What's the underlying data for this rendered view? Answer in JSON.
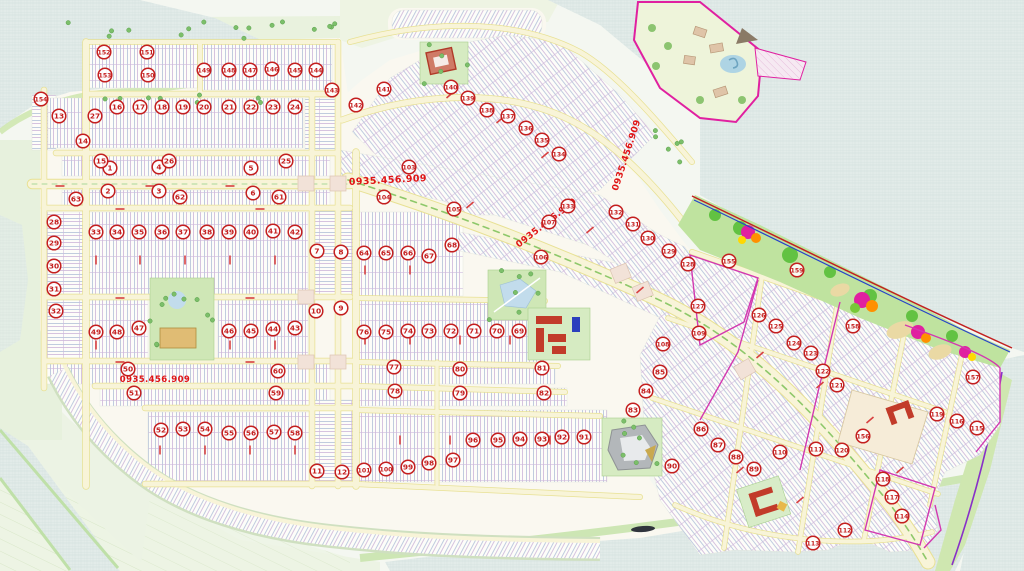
{
  "map": {
    "type": "real-estate-master-plan",
    "watermark": {
      "text": "0935.456.909",
      "color": "#e01414",
      "positions": [
        {
          "x": 388,
          "y": 183,
          "rot": -3,
          "size": 9.5
        },
        {
          "x": 548,
          "y": 225,
          "rot": -38,
          "size": 9
        },
        {
          "x": 629,
          "y": 156,
          "rot": -72,
          "size": 9
        },
        {
          "x": 155,
          "y": 382,
          "rot": 0,
          "size": 8.5
        }
      ]
    },
    "marker_style": {
      "ring_color": "#c41f1f",
      "fill": "#ffffff"
    },
    "markers": {
      "items": [
        [
          1,
          110,
          168
        ],
        [
          2,
          108,
          191
        ],
        [
          3,
          159,
          191
        ],
        [
          4,
          159,
          167
        ],
        [
          5,
          251,
          168
        ],
        [
          6,
          253,
          193
        ],
        [
          7,
          317,
          251
        ],
        [
          8,
          341,
          252
        ],
        [
          9,
          341,
          308
        ],
        [
          10,
          316,
          311
        ],
        [
          11,
          317,
          471
        ],
        [
          12,
          342,
          472
        ],
        [
          13,
          59,
          116
        ],
        [
          14,
          83,
          141
        ],
        [
          15,
          101,
          161
        ],
        [
          16,
          117,
          107
        ],
        [
          17,
          140,
          107
        ],
        [
          18,
          162,
          107
        ],
        [
          19,
          183,
          107
        ],
        [
          20,
          204,
          107
        ],
        [
          21,
          229,
          107
        ],
        [
          22,
          251,
          107
        ],
        [
          23,
          273,
          107
        ],
        [
          24,
          295,
          107
        ],
        [
          25,
          286,
          161
        ],
        [
          26,
          169,
          161
        ],
        [
          27,
          95,
          116
        ],
        [
          28,
          54,
          222
        ],
        [
          29,
          54,
          243
        ],
        [
          30,
          54,
          266
        ],
        [
          31,
          54,
          289
        ],
        [
          32,
          56,
          311
        ],
        [
          33,
          96,
          232
        ],
        [
          34,
          117,
          232
        ],
        [
          35,
          139,
          232
        ],
        [
          36,
          162,
          232
        ],
        [
          37,
          183,
          232
        ],
        [
          38,
          207,
          232
        ],
        [
          39,
          229,
          232
        ],
        [
          40,
          251,
          232
        ],
        [
          41,
          273,
          231
        ],
        [
          42,
          295,
          232
        ],
        [
          43,
          295,
          328
        ],
        [
          44,
          273,
          329
        ],
        [
          45,
          251,
          331
        ],
        [
          46,
          229,
          331
        ],
        [
          47,
          139,
          328
        ],
        [
          48,
          117,
          332
        ],
        [
          49,
          96,
          332
        ],
        [
          50,
          128,
          369
        ],
        [
          51,
          134,
          393
        ],
        [
          52,
          161,
          430
        ],
        [
          53,
          183,
          429
        ],
        [
          54,
          205,
          429
        ],
        [
          55,
          229,
          433
        ],
        [
          56,
          251,
          433
        ],
        [
          57,
          274,
          432
        ],
        [
          58,
          295,
          433
        ],
        [
          59,
          276,
          393
        ],
        [
          60,
          278,
          371
        ],
        [
          61,
          279,
          197
        ],
        [
          62,
          180,
          197
        ],
        [
          63,
          76,
          199
        ],
        [
          64,
          364,
          253
        ],
        [
          65,
          386,
          253
        ],
        [
          66,
          408,
          253
        ],
        [
          67,
          429,
          256
        ],
        [
          68,
          452,
          245
        ],
        [
          69,
          519,
          331
        ],
        [
          70,
          497,
          331
        ],
        [
          71,
          474,
          331
        ],
        [
          72,
          451,
          331
        ],
        [
          73,
          429,
          331
        ],
        [
          74,
          408,
          331
        ],
        [
          75,
          386,
          332
        ],
        [
          76,
          364,
          332
        ],
        [
          77,
          394,
          367
        ],
        [
          78,
          395,
          391
        ],
        [
          79,
          460,
          393
        ],
        [
          80,
          460,
          369
        ],
        [
          81,
          542,
          368
        ],
        [
          82,
          544,
          393
        ],
        [
          83,
          633,
          410
        ],
        [
          84,
          646,
          391
        ],
        [
          85,
          660,
          372
        ],
        [
          86,
          701,
          429
        ],
        [
          87,
          718,
          445
        ],
        [
          88,
          736,
          457
        ],
        [
          89,
          754,
          469
        ],
        [
          90,
          672,
          466
        ],
        [
          91,
          584,
          437
        ],
        [
          92,
          562,
          437
        ],
        [
          93,
          542,
          439
        ],
        [
          94,
          520,
          439
        ],
        [
          95,
          498,
          440
        ],
        [
          96,
          473,
          440
        ],
        [
          97,
          453,
          460
        ],
        [
          98,
          429,
          463
        ],
        [
          99,
          408,
          467
        ],
        [
          100,
          386,
          469
        ],
        [
          101,
          364,
          470
        ],
        [
          103,
          409,
          167
        ],
        [
          104,
          384,
          197
        ],
        [
          105,
          454,
          209
        ],
        [
          106,
          541,
          257
        ],
        [
          107,
          549,
          222
        ],
        [
          108,
          663,
          344
        ],
        [
          109,
          699,
          333
        ],
        [
          110,
          780,
          452
        ],
        [
          111,
          816,
          449
        ],
        [
          112,
          845,
          530
        ],
        [
          113,
          813,
          543
        ],
        [
          114,
          902,
          516
        ],
        [
          115,
          977,
          428
        ],
        [
          116,
          957,
          421
        ],
        [
          117,
          892,
          497
        ],
        [
          118,
          883,
          479
        ],
        [
          119,
          937,
          414
        ],
        [
          120,
          842,
          450
        ],
        [
          121,
          837,
          385
        ],
        [
          122,
          823,
          371
        ],
        [
          123,
          811,
          353
        ],
        [
          124,
          794,
          343
        ],
        [
          125,
          776,
          326
        ],
        [
          126,
          759,
          315
        ],
        [
          127,
          698,
          306
        ],
        [
          128,
          688,
          264
        ],
        [
          129,
          669,
          251
        ],
        [
          130,
          648,
          238
        ],
        [
          131,
          633,
          224
        ],
        [
          132,
          616,
          212
        ],
        [
          133,
          568,
          206
        ],
        [
          134,
          559,
          154
        ],
        [
          135,
          542,
          140
        ],
        [
          136,
          526,
          128
        ],
        [
          137,
          508,
          116
        ],
        [
          138,
          487,
          110
        ],
        [
          139,
          468,
          98
        ],
        [
          140,
          451,
          87
        ],
        [
          141,
          384,
          89
        ],
        [
          142,
          356,
          105
        ],
        [
          143,
          332,
          90
        ],
        [
          144,
          316,
          70
        ],
        [
          145,
          295,
          70
        ],
        [
          146,
          272,
          69
        ],
        [
          147,
          250,
          70
        ],
        [
          148,
          229,
          70
        ],
        [
          149,
          204,
          70
        ],
        [
          150,
          148,
          75
        ],
        [
          151,
          147,
          52
        ],
        [
          152,
          104,
          52
        ],
        [
          153,
          105,
          75
        ],
        [
          154,
          41,
          99
        ],
        [
          155,
          729,
          261
        ],
        [
          156,
          863,
          436
        ],
        [
          157,
          973,
          377
        ],
        [
          158,
          853,
          326
        ],
        [
          159,
          797,
          270
        ]
      ]
    },
    "palette": {
      "water": "#e2ebe9",
      "land": "#faf8f0",
      "green_margin": "#e9f2de",
      "park": "#cfe7b6",
      "road": "#f8f4d8",
      "road_edge": "#e8e194",
      "lot_blue": "#b9c7dc",
      "lot_purple": "#c6abd5",
      "boundary_magenta": "#e020a0",
      "shoreline_red": "#c22020",
      "shoreline_blue": "#2743c8",
      "building_red": "#c23b2a",
      "building_blue": "#2b3fbd"
    }
  }
}
